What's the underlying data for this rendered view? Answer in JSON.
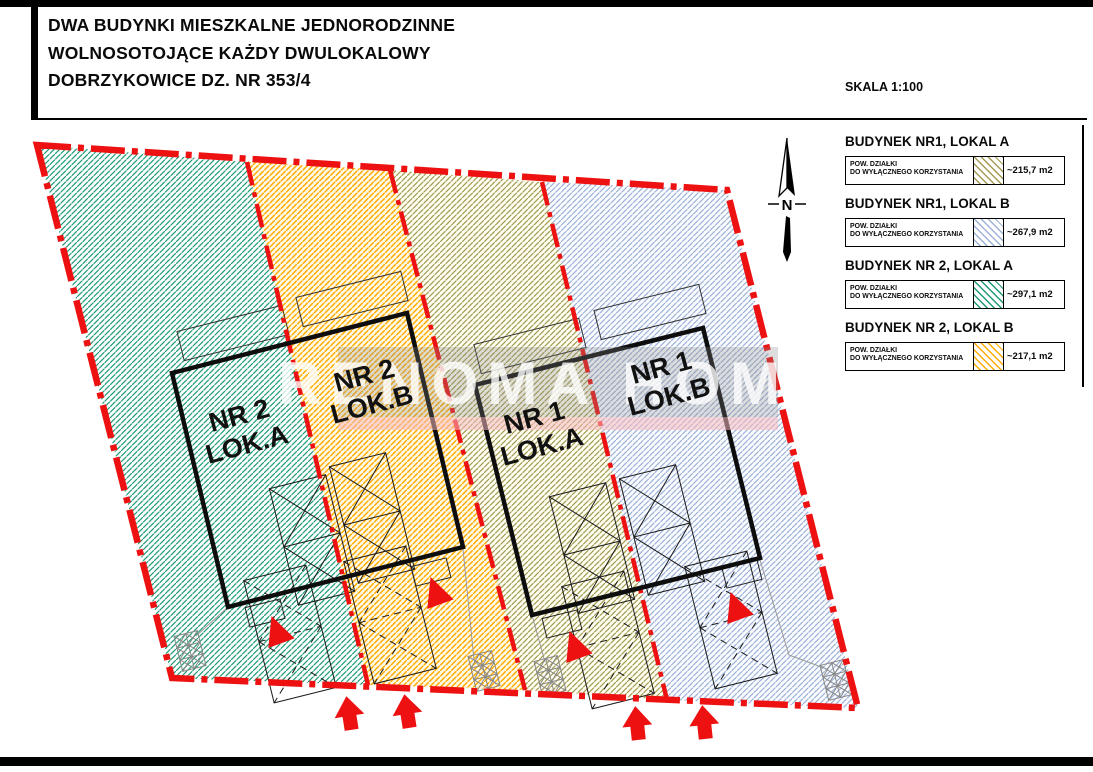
{
  "header": {
    "title_line1": "DWA BUDYNKI MIESZKALNE JEDNORODZINNE",
    "title_line2": "WOLNOSOTOJĄCE KAŻDY DWULOKALOWY",
    "title_line3": "DOBRZYKOWICE DZ. NR 353/4",
    "scale_label": "SKALA 1:100"
  },
  "north": {
    "label": "N"
  },
  "watermark": {
    "text": "RENOMA HOME"
  },
  "plan": {
    "units": [
      {
        "line1": "NR 2",
        "line2": "LOK.A"
      },
      {
        "line1": "NR 2",
        "line2": "LOK.B"
      },
      {
        "line1": "NR 1",
        "line2": "LOK.A"
      },
      {
        "line1": "NR 1",
        "line2": "LOK.B"
      }
    ]
  },
  "legend": {
    "items": [
      {
        "title": "BUDYNEK NR1, LOKAL A",
        "desc_line1": "POW. DZIAŁKI",
        "desc_line2": "DO WYŁĄCZNEGO KORZYSTANIA",
        "area": "~215,7 m2",
        "hatch_color": "#a39a52"
      },
      {
        "title": "BUDYNEK NR1, LOKAL B",
        "desc_line1": "POW. DZIAŁKI",
        "desc_line2": "DO WYŁĄCZNEGO KORZYSTANIA",
        "area": "~267,9 m2",
        "hatch_color": "#9db2d6"
      },
      {
        "title": "BUDYNEK NR 2, LOKAL A",
        "desc_line1": "POW. DZIAŁKI",
        "desc_line2": "DO WYŁĄCZNEGO KORZYSTANIA",
        "area": "~297,1 m2",
        "hatch_color": "#1f9b76"
      },
      {
        "title": "BUDYNEK NR 2, LOKAL B",
        "desc_line1": "POW. DZIAŁKI",
        "desc_line2": "DO WYŁĄCZNEGO KORZYSTANIA",
        "area": "~217,1 m2",
        "hatch_color": "#ffaa00"
      }
    ]
  },
  "colors": {
    "boundary_red": "#ee1111",
    "hatch_nr2_a": "#1f9b76",
    "hatch_nr2_b": "#ffaa00",
    "hatch_nr1_a": "#a39a52",
    "hatch_nr1_b": "#9db2d6"
  }
}
